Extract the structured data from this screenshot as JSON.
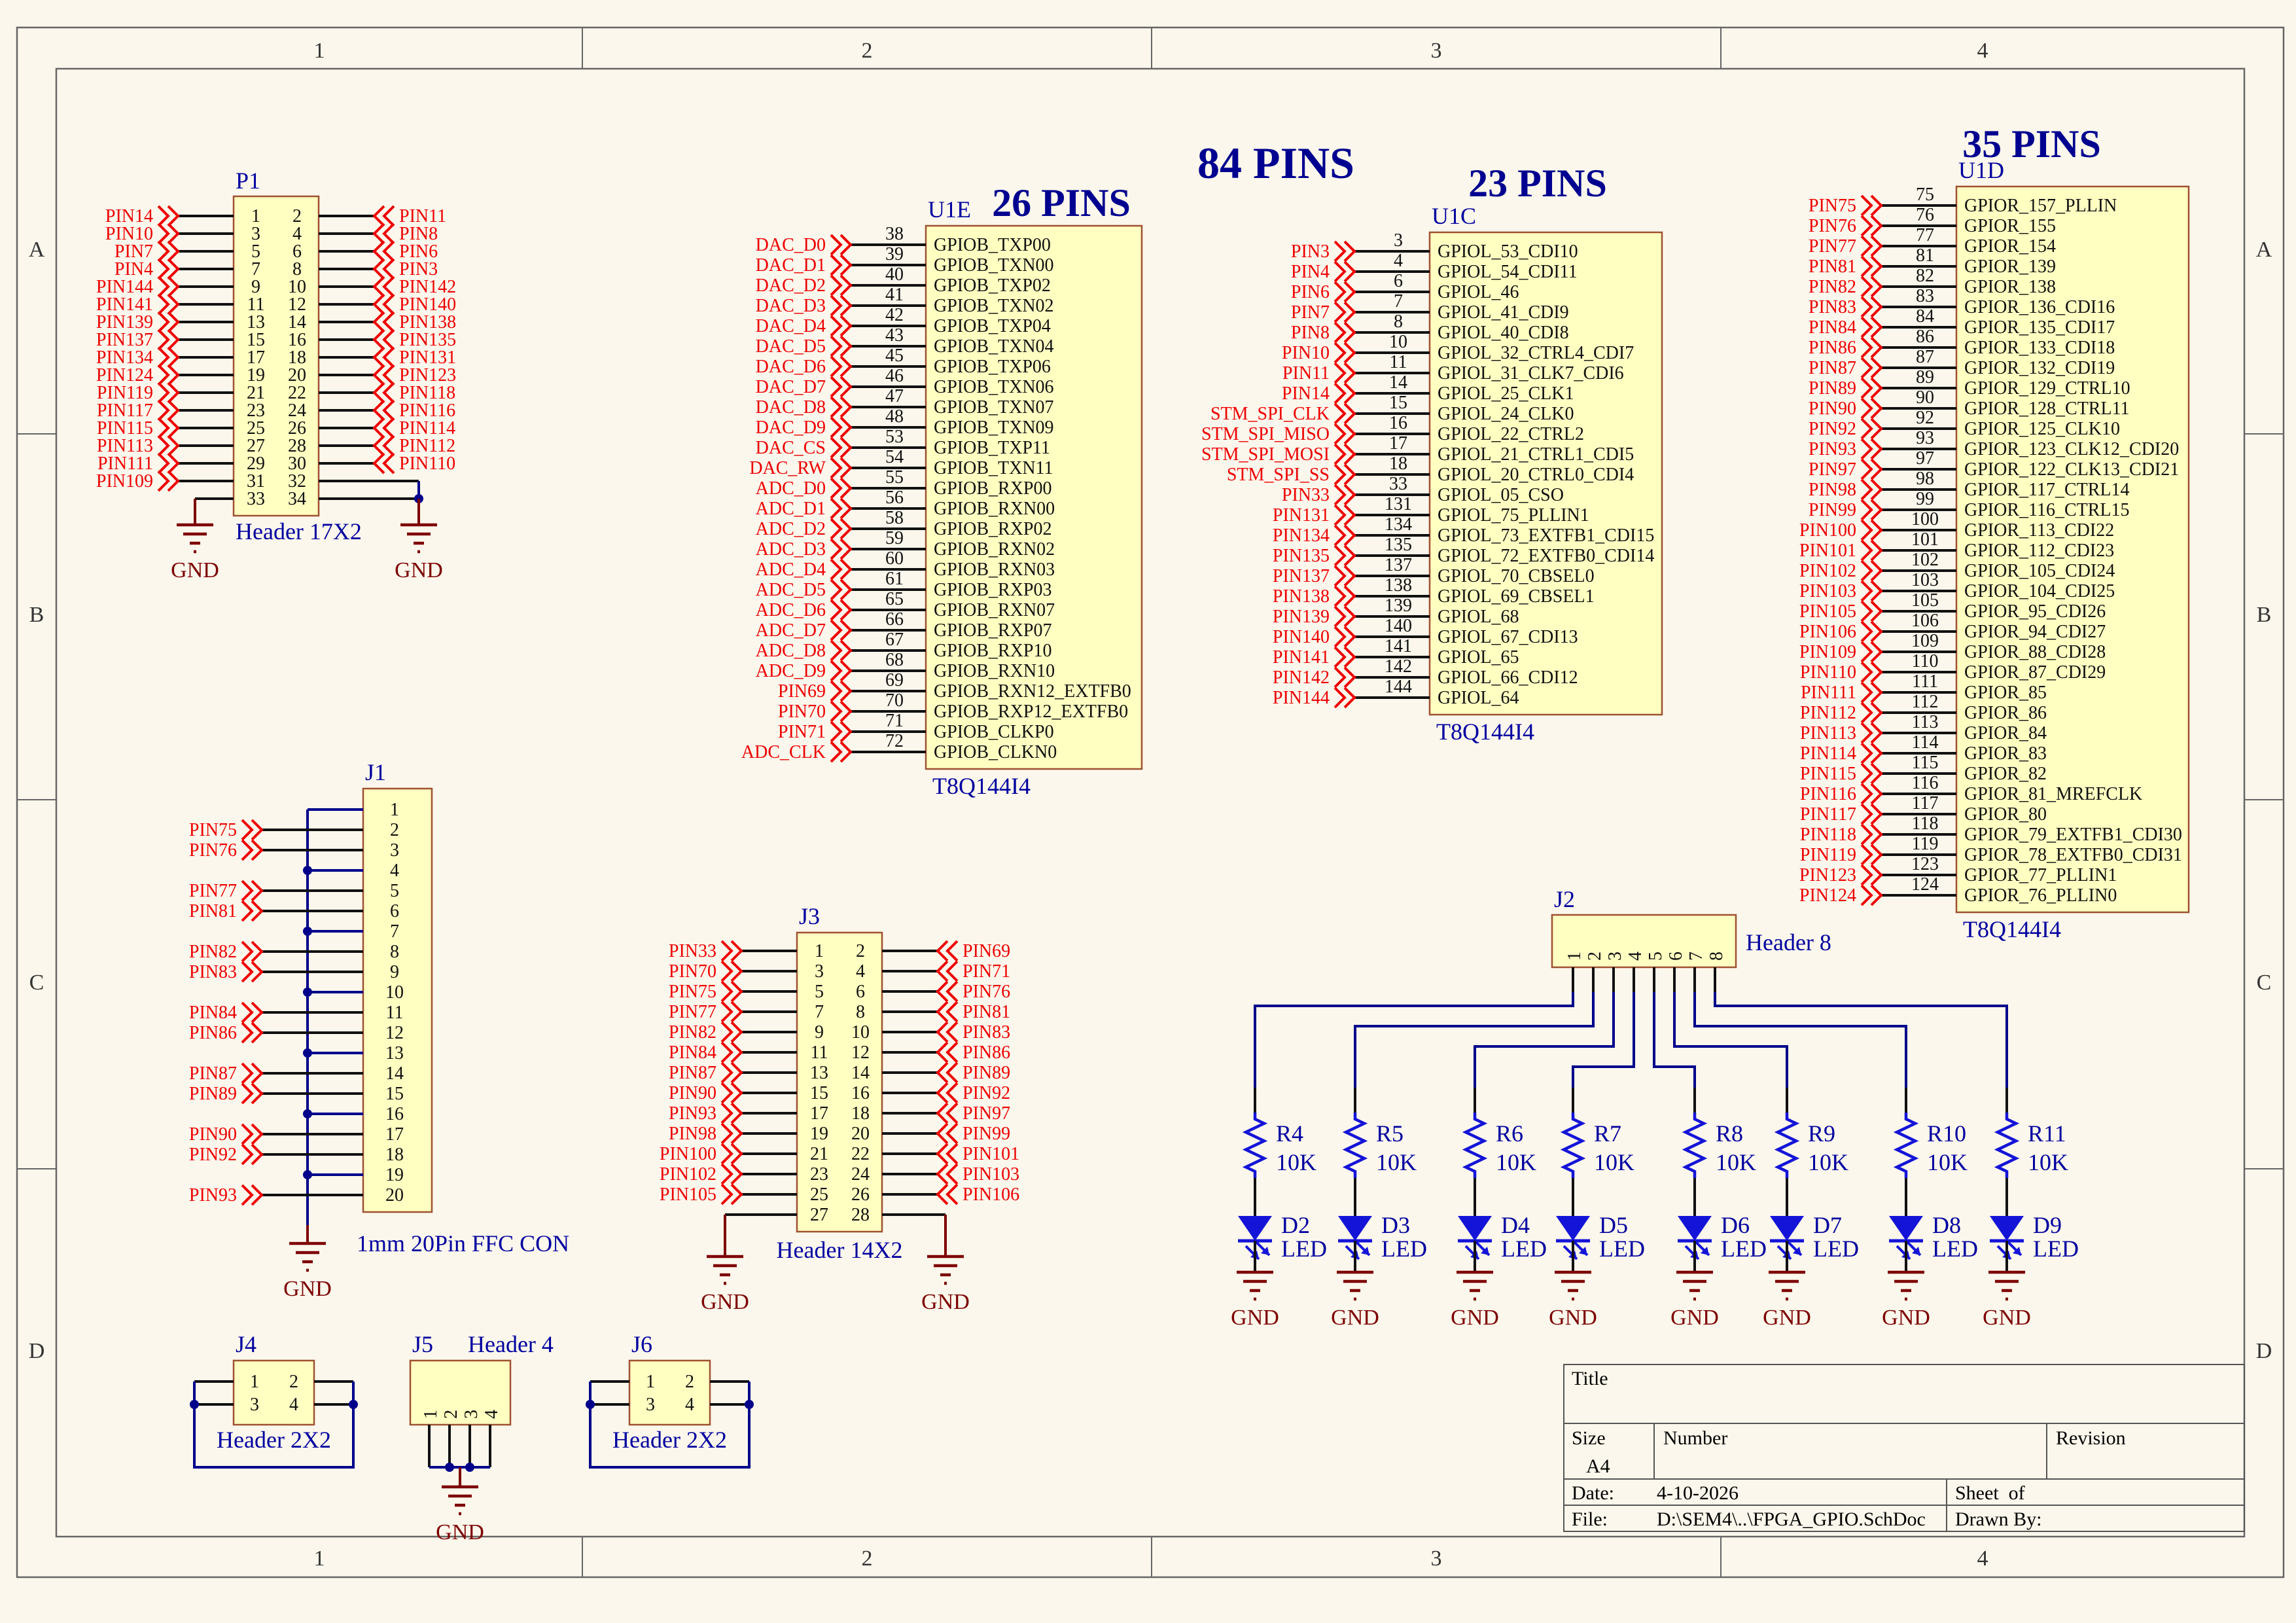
{
  "sheet": {
    "background": "#fbf7ec",
    "frame": {
      "columns": [
        "1",
        "2",
        "3",
        "4"
      ],
      "rows": [
        "A",
        "B",
        "C",
        "D"
      ]
    }
  },
  "colors": {
    "wire_blue": "#00008b",
    "pin_black": "#111111",
    "net_red": "#ee0000",
    "designator_blue": "#0000a0",
    "heading_navy": "#000090",
    "body_fill": "#ffffc2",
    "body_border": "#9f5130",
    "gnd_maroon": "#7d0000",
    "symbol_blue": "#1414d8"
  },
  "headings": {
    "p84": "84 PINS",
    "p26": "26 PINS",
    "p23": "23 PINS",
    "p35": "35 PINS"
  },
  "gnd_label": "GND",
  "ics": [
    {
      "ref": "U1E",
      "part": "T8Q144I4",
      "pins": [
        [
          "DAC_D0",
          "38",
          "GPIOB_TXP00"
        ],
        [
          "DAC_D1",
          "39",
          "GPIOB_TXN00"
        ],
        [
          "DAC_D2",
          "40",
          "GPIOB_TXP02"
        ],
        [
          "DAC_D3",
          "41",
          "GPIOB_TXN02"
        ],
        [
          "DAC_D4",
          "42",
          "GPIOB_TXP04"
        ],
        [
          "DAC_D5",
          "43",
          "GPIOB_TXN04"
        ],
        [
          "DAC_D6",
          "45",
          "GPIOB_TXP06"
        ],
        [
          "DAC_D7",
          "46",
          "GPIOB_TXN06"
        ],
        [
          "DAC_D8",
          "47",
          "GPIOB_TXN07"
        ],
        [
          "DAC_D9",
          "48",
          "GPIOB_TXN09"
        ],
        [
          "DAC_CS",
          "53",
          "GPIOB_TXP11"
        ],
        [
          "DAC_RW",
          "54",
          "GPIOB_TXN11"
        ],
        [
          "ADC_D0",
          "55",
          "GPIOB_RXP00"
        ],
        [
          "ADC_D1",
          "56",
          "GPIOB_RXN00"
        ],
        [
          "ADC_D2",
          "58",
          "GPIOB_RXP02"
        ],
        [
          "ADC_D3",
          "59",
          "GPIOB_RXN02"
        ],
        [
          "ADC_D4",
          "60",
          "GPIOB_RXN03"
        ],
        [
          "ADC_D5",
          "61",
          "GPIOB_RXP03"
        ],
        [
          "ADC_D6",
          "65",
          "GPIOB_RXN07"
        ],
        [
          "ADC_D7",
          "66",
          "GPIOB_RXP07"
        ],
        [
          "ADC_D8",
          "67",
          "GPIOB_RXP10"
        ],
        [
          "ADC_D9",
          "68",
          "GPIOB_RXN10"
        ],
        [
          "PIN69",
          "69",
          "GPIOB_RXN12_EXTFB0"
        ],
        [
          "PIN70",
          "70",
          "GPIOB_RXP12_EXTFB0"
        ],
        [
          "PIN71",
          "71",
          "GPIOB_CLKP0"
        ],
        [
          "ADC_CLK",
          "72",
          "GPIOB_CLKN0"
        ]
      ]
    },
    {
      "ref": "U1C",
      "part": "T8Q144I4",
      "pins": [
        [
          "PIN3",
          "3",
          "GPIOL_53_CDI10"
        ],
        [
          "PIN4",
          "4",
          "GPIOL_54_CDI11"
        ],
        [
          "PIN6",
          "6",
          "GPIOL_46"
        ],
        [
          "PIN7",
          "7",
          "GPIOL_41_CDI9"
        ],
        [
          "PIN8",
          "8",
          "GPIOL_40_CDI8"
        ],
        [
          "PIN10",
          "10",
          "GPIOL_32_CTRL4_CDI7"
        ],
        [
          "PIN11",
          "11",
          "GPIOL_31_CLK7_CDI6"
        ],
        [
          "PIN14",
          "14",
          "GPIOL_25_CLK1"
        ],
        [
          "STM_SPI_CLK",
          "15",
          "GPIOL_24_CLK0"
        ],
        [
          "STM_SPI_MISO",
          "16",
          "GPIOL_22_CTRL2"
        ],
        [
          "STM_SPI_MOSI",
          "17",
          "GPIOL_21_CTRL1_CDI5"
        ],
        [
          "STM_SPI_SS",
          "18",
          "GPIOL_20_CTRL0_CDI4"
        ],
        [
          "PIN33",
          "33",
          "GPIOL_05_CSO"
        ],
        [
          "PIN131",
          "131",
          "GPIOL_75_PLLIN1"
        ],
        [
          "PIN134",
          "134",
          "GPIOL_73_EXTFB1_CDI15"
        ],
        [
          "PIN135",
          "135",
          "GPIOL_72_EXTFB0_CDI14"
        ],
        [
          "PIN137",
          "137",
          "GPIOL_70_CBSEL0"
        ],
        [
          "PIN138",
          "138",
          "GPIOL_69_CBSEL1"
        ],
        [
          "PIN139",
          "139",
          "GPIOL_68"
        ],
        [
          "PIN140",
          "140",
          "GPIOL_67_CDI13"
        ],
        [
          "PIN141",
          "141",
          "GPIOL_65"
        ],
        [
          "PIN142",
          "142",
          "GPIOL_66_CDI12"
        ],
        [
          "PIN144",
          "144",
          "GPIOL_64"
        ]
      ]
    },
    {
      "ref": "U1D",
      "part": "T8Q144I4",
      "pins": [
        [
          "PIN75",
          "75",
          "GPIOR_157_PLLIN"
        ],
        [
          "PIN76",
          "76",
          "GPIOR_155"
        ],
        [
          "PIN77",
          "77",
          "GPIOR_154"
        ],
        [
          "PIN81",
          "81",
          "GPIOR_139"
        ],
        [
          "PIN82",
          "82",
          "GPIOR_138"
        ],
        [
          "PIN83",
          "83",
          "GPIOR_136_CDI16"
        ],
        [
          "PIN84",
          "84",
          "GPIOR_135_CDI17"
        ],
        [
          "PIN86",
          "86",
          "GPIOR_133_CDI18"
        ],
        [
          "PIN87",
          "87",
          "GPIOR_132_CDI19"
        ],
        [
          "PIN89",
          "89",
          "GPIOR_129_CTRL10"
        ],
        [
          "PIN90",
          "90",
          "GPIOR_128_CTRL11"
        ],
        [
          "PIN92",
          "92",
          "GPIOR_125_CLK10"
        ],
        [
          "PIN93",
          "93",
          "GPIOR_123_CLK12_CDI20"
        ],
        [
          "PIN97",
          "97",
          "GPIOR_122_CLK13_CDI21"
        ],
        [
          "PIN98",
          "98",
          "GPIOR_117_CTRL14"
        ],
        [
          "PIN99",
          "99",
          "GPIOR_116_CTRL15"
        ],
        [
          "PIN100",
          "100",
          "GPIOR_113_CDI22"
        ],
        [
          "PIN101",
          "101",
          "GPIOR_112_CDI23"
        ],
        [
          "PIN102",
          "102",
          "GPIOR_105_CDI24"
        ],
        [
          "PIN103",
          "103",
          "GPIOR_104_CDI25"
        ],
        [
          "PIN105",
          "105",
          "GPIOR_95_CDI26"
        ],
        [
          "PIN106",
          "106",
          "GPIOR_94_CDI27"
        ],
        [
          "PIN109",
          "109",
          "GPIOR_88_CDI28"
        ],
        [
          "PIN110",
          "110",
          "GPIOR_87_CDI29"
        ],
        [
          "PIN111",
          "111",
          "GPIOR_85"
        ],
        [
          "PIN112",
          "112",
          "GPIOR_86"
        ],
        [
          "PIN113",
          "113",
          "GPIOR_84"
        ],
        [
          "PIN114",
          "114",
          "GPIOR_83"
        ],
        [
          "PIN115",
          "115",
          "GPIOR_82"
        ],
        [
          "PIN116",
          "116",
          "GPIOR_81_MREFCLK"
        ],
        [
          "PIN117",
          "117",
          "GPIOR_80"
        ],
        [
          "PIN118",
          "118",
          "GPIOR_79_EXTFB1_CDI30"
        ],
        [
          "PIN119",
          "119",
          "GPIOR_78_EXTFB0_CDI31"
        ],
        [
          "PIN123",
          "123",
          "GPIOR_77_PLLIN1"
        ],
        [
          "PIN124",
          "124",
          "GPIOR_76_PLLIN0"
        ]
      ]
    }
  ],
  "p1": {
    "ref": "P1",
    "part": "Header 17X2",
    "rows": [
      [
        "PIN14",
        "1",
        "2",
        "PIN11"
      ],
      [
        "PIN10",
        "3",
        "4",
        "PIN8"
      ],
      [
        "PIN7",
        "5",
        "6",
        "PIN6"
      ],
      [
        "PIN4",
        "7",
        "8",
        "PIN3"
      ],
      [
        "PIN144",
        "9",
        "10",
        "PIN142"
      ],
      [
        "PIN141",
        "11",
        "12",
        "PIN140"
      ],
      [
        "PIN139",
        "13",
        "14",
        "PIN138"
      ],
      [
        "PIN137",
        "15",
        "16",
        "PIN135"
      ],
      [
        "PIN134",
        "17",
        "18",
        "PIN131"
      ],
      [
        "PIN124",
        "19",
        "20",
        "PIN123"
      ],
      [
        "PIN119",
        "21",
        "22",
        "PIN118"
      ],
      [
        "PIN117",
        "23",
        "24",
        "PIN116"
      ],
      [
        "PIN115",
        "25",
        "26",
        "PIN114"
      ],
      [
        "PIN113",
        "27",
        "28",
        "PIN112"
      ],
      [
        "PIN111",
        "29",
        "30",
        "PIN110"
      ],
      [
        "PIN109",
        "31",
        "32",
        null
      ],
      [
        null,
        "33",
        "34",
        null
      ]
    ]
  },
  "j1": {
    "ref": "J1",
    "part": "1mm 20Pin FFC CON",
    "rows": [
      [
        "1",
        null
      ],
      [
        "2",
        "PIN75"
      ],
      [
        "3",
        "PIN76"
      ],
      [
        "4",
        null
      ],
      [
        "5",
        "PIN77"
      ],
      [
        "6",
        "PIN81"
      ],
      [
        "7",
        null
      ],
      [
        "8",
        "PIN82"
      ],
      [
        "9",
        "PIN83"
      ],
      [
        "10",
        null
      ],
      [
        "11",
        "PIN84"
      ],
      [
        "12",
        "PIN86"
      ],
      [
        "13",
        null
      ],
      [
        "14",
        "PIN87"
      ],
      [
        "15",
        "PIN89"
      ],
      [
        "16",
        null
      ],
      [
        "17",
        "PIN90"
      ],
      [
        "18",
        "PIN92"
      ],
      [
        "19",
        null
      ],
      [
        "20",
        "PIN93"
      ]
    ]
  },
  "j3": {
    "ref": "J3",
    "part": "Header 14X2",
    "rows": [
      [
        "PIN33",
        "1",
        "2",
        "PIN69"
      ],
      [
        "PIN70",
        "3",
        "4",
        "PIN71"
      ],
      [
        "PIN75",
        "5",
        "6",
        "PIN76"
      ],
      [
        "PIN77",
        "7",
        "8",
        "PIN81"
      ],
      [
        "PIN82",
        "9",
        "10",
        "PIN83"
      ],
      [
        "PIN84",
        "11",
        "12",
        "PIN86"
      ],
      [
        "PIN87",
        "13",
        "14",
        "PIN89"
      ],
      [
        "PIN90",
        "15",
        "16",
        "PIN92"
      ],
      [
        "PIN93",
        "17",
        "18",
        "PIN97"
      ],
      [
        "PIN98",
        "19",
        "20",
        "PIN99"
      ],
      [
        "PIN100",
        "21",
        "22",
        "PIN101"
      ],
      [
        "PIN102",
        "23",
        "24",
        "PIN103"
      ],
      [
        "PIN105",
        "25",
        "26",
        "PIN106"
      ],
      [
        null,
        "27",
        "28",
        null
      ]
    ]
  },
  "j2": {
    "ref": "J2",
    "part": "Header 8",
    "pins": [
      "1",
      "2",
      "3",
      "4",
      "5",
      "6",
      "7",
      "8"
    ]
  },
  "led_chains": [
    {
      "res": "R4",
      "val": "10K",
      "led": "D2",
      "typ": "LED"
    },
    {
      "res": "R5",
      "val": "10K",
      "led": "D3",
      "typ": "LED"
    },
    {
      "res": "R6",
      "val": "10K",
      "led": "D4",
      "typ": "LED"
    },
    {
      "res": "R7",
      "val": "10K",
      "led": "D5",
      "typ": "LED"
    },
    {
      "res": "R8",
      "val": "10K",
      "led": "D6",
      "typ": "LED"
    },
    {
      "res": "R9",
      "val": "10K",
      "led": "D7",
      "typ": "LED"
    },
    {
      "res": "R10",
      "val": "10K",
      "led": "D8",
      "typ": "LED"
    },
    {
      "res": "R11",
      "val": "10K",
      "led": "D9",
      "typ": "LED"
    }
  ],
  "j4": {
    "ref": "J4",
    "part": "Header 2X2",
    "pins": [
      "1",
      "2",
      "3",
      "4"
    ]
  },
  "j5": {
    "ref": "J5",
    "part": "Header 4",
    "pins": [
      "1",
      "2",
      "3",
      "4"
    ]
  },
  "j6": {
    "ref": "J6",
    "part": "Header 2X2",
    "pins": [
      "1",
      "2",
      "3",
      "4"
    ]
  },
  "title_block": {
    "title_label": "Title",
    "size_label": "Size",
    "size_value": "A4",
    "number_label": "Number",
    "revision_label": "Revision",
    "date_label": "Date:",
    "date_value": "4-10-2026",
    "sheet_label": "Sheet  of",
    "file_label": "File:",
    "file_value": "D:\\SEM4\\..\\FPGA_GPIO.SchDoc",
    "drawn_label": "Drawn By:"
  }
}
